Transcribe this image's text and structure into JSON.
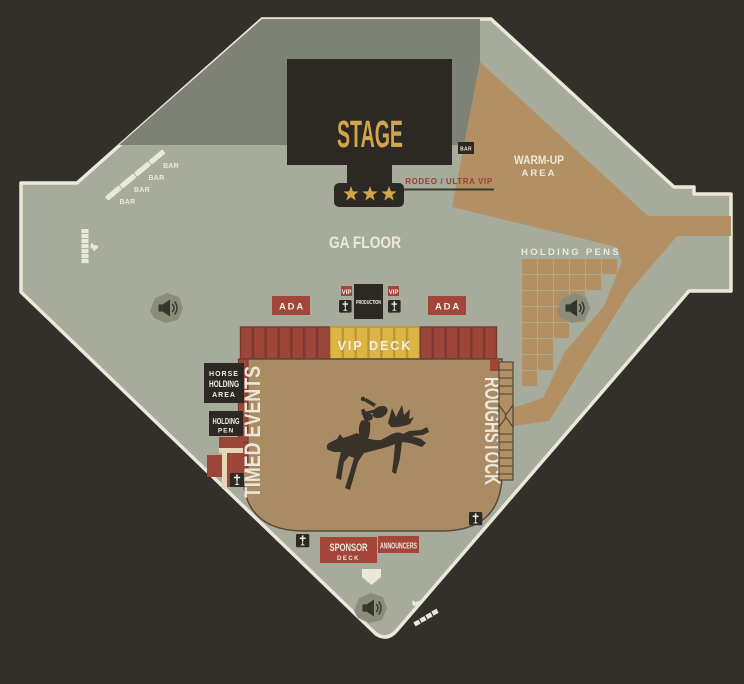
{
  "venue": {
    "stage_label": "STAGE",
    "stage_bar_tag": "BAR",
    "rodeo_vip_label": "RODEO / ULTRA VIP",
    "ga_floor_label": "GA FLOOR",
    "warmup_area_label_line1": "WARM-UP",
    "warmup_area_label_line2": "AREA",
    "holding_pens_label": "HOLDING PENS",
    "bar_labels": [
      "BAR",
      "BAR",
      "BAR",
      "BAR"
    ],
    "ada_left_label": "ADA",
    "ada_right_label": "ADA",
    "vip_tag_left": "VIP",
    "vip_tag_right": "VIP",
    "production_label": "PRODUCTION",
    "vip_deck_label": "VIP DECK",
    "timed_events_label": "TIMED EVENTS",
    "roughstock_label": "ROUGHSTOCK",
    "horse_holding_area_label": {
      "line1": "HORSE",
      "line2": "HOLDING",
      "line3": "AREA"
    },
    "holding_pen_label": {
      "line1": "HOLDING",
      "line2": "PEN"
    },
    "sponsor_deck_label": {
      "line1": "SPONSOR",
      "line2": "DECK"
    },
    "announcers_label": "ANNOUNCERS"
  },
  "icons": {
    "speaker": "speaker-icon",
    "first_aid": "first-aid-icon",
    "restroom": "restroom-icon",
    "star": "star-icon",
    "home_plate": "home-plate-marker",
    "centerpiece": "bucking-horse-rider-silhouette"
  },
  "colors": {
    "background": "#32302b",
    "floor": "#a7ab9b",
    "backstage_grey": "#7e8175",
    "path_tan": "#b29064",
    "arena_dirt": "#a98c63",
    "block_red": "#9c4539",
    "label_red": "#a34539",
    "vip_yellow": "#ddb545",
    "box_black": "#2c2924",
    "cream": "#ece8d9",
    "gold": "#d2a44c"
  }
}
